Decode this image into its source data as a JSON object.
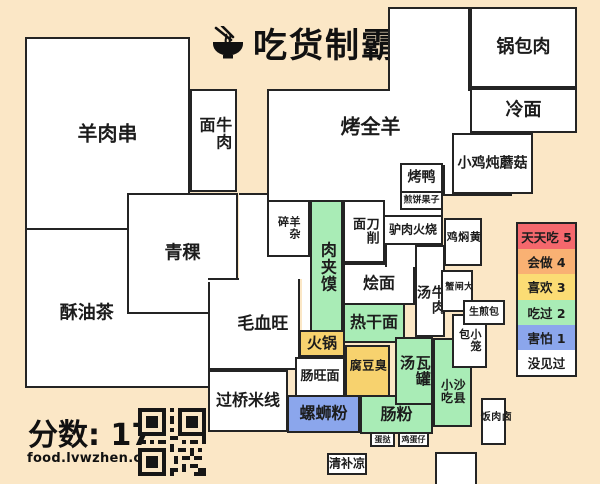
{
  "page": {
    "title": "吃货制霸",
    "score_label": "分数: 17",
    "url": "food.lvwzhen.com"
  },
  "colors": {
    "bg": "#fbe7c6",
    "border": "#242424",
    "w": "#ffffff",
    "g": "#a9ecb6",
    "y": "#f7d26e",
    "b": "#8ba6ec",
    "red": "#f5686d",
    "orange": "#f9b173",
    "lemon": "#fbdc74"
  },
  "legend": {
    "items": [
      {
        "label": "天天吃 5",
        "color": "#f5686d"
      },
      {
        "label": "会做 4",
        "color": "#f9b173"
      },
      {
        "label": "喜欢 3",
        "color": "#fbdc74"
      },
      {
        "label": "吃过 2",
        "color": "#a9ecb6"
      },
      {
        "label": "害怕 1",
        "color": "#8ba6ec"
      },
      {
        "label": "没见过",
        "color": "#ffffff"
      }
    ]
  },
  "regions": [
    {
      "n": "kaoquanyang",
      "t": "烤全羊",
      "x": 267,
      "y": 89,
      "w": 176,
      "h": 128,
      "fs": 20,
      "lx": 59,
      "ly": 29
    },
    {
      "n": "kaoquanyang-east",
      "t": "",
      "x": 443,
      "y": 89,
      "w": 69,
      "h": 107
    },
    {
      "n": "kaoquanyang-north",
      "t": "",
      "x": 388,
      "y": 7,
      "w": 82,
      "h": 84
    },
    {
      "n": "seam-north",
      "t": "",
      "x": 390,
      "y": 86,
      "w": 78,
      "h": 8,
      "br": "none"
    },
    {
      "n": "seam-east",
      "t": "",
      "x": 441,
      "y": 91,
      "w": 6,
      "h": 74,
      "br": "none"
    },
    {
      "n": "guobaorou",
      "t": "锅包肉",
      "x": 470,
      "y": 7,
      "w": 107,
      "h": 81,
      "fs": 18
    },
    {
      "n": "lengmian",
      "t": "冷面",
      "x": 470,
      "y": 88,
      "w": 107,
      "h": 45,
      "fs": 18
    },
    {
      "n": "xiaojidunmogu",
      "t": "小鸡炖蘑菇",
      "x": 452,
      "y": 133,
      "w": 81,
      "h": 61,
      "fs": 14
    },
    {
      "n": "yangrouchuan",
      "t": "羊肉串",
      "x": 25,
      "y": 37,
      "w": 165,
      "h": 193,
      "fs": 20
    },
    {
      "n": "niuroumian",
      "t": "牛肉面",
      "x": 190,
      "y": 89,
      "w": 47,
      "h": 103,
      "fs": 16,
      "v": 1
    },
    {
      "n": "suyoucha",
      "t": "酥油茶",
      "x": 25,
      "y": 228,
      "w": 185,
      "h": 160,
      "fs": 18,
      "lx": 33,
      "ly": 54
    },
    {
      "n": "qingke",
      "t": "青稞",
      "x": 127,
      "y": 193,
      "w": 111,
      "h": 121,
      "fs": 18
    },
    {
      "n": "maoxuewang",
      "t": "毛血旺",
      "x": 208,
      "y": 278,
      "w": 92,
      "h": 92,
      "fs": 17,
      "lx": 60,
      "ly": 52,
      "br": "lrb"
    },
    {
      "n": "maoxuewang-topline",
      "t": "",
      "x": 208,
      "y": 278,
      "w": 31,
      "h": 4,
      "br": "top"
    },
    {
      "n": "yangzasui",
      "t": "羊杂碎",
      "x": 267,
      "y": 200,
      "w": 43,
      "h": 57,
      "fs": 11,
      "v": 1
    },
    {
      "n": "gap-west",
      "t": "",
      "x": 239,
      "y": 193,
      "w": 28,
      "h": 89,
      "br": "top"
    },
    {
      "n": "gap-mid",
      "t": "",
      "x": 267,
      "y": 257,
      "w": 43,
      "h": 22,
      "br": "none"
    },
    {
      "n": "gap-east",
      "t": "",
      "x": 302,
      "y": 257,
      "w": 8,
      "h": 75,
      "br": "none"
    },
    {
      "n": "roujiamo",
      "t": "肉夹馍",
      "x": 310,
      "y": 200,
      "w": 33,
      "h": 133,
      "fs": 16,
      "v": 1,
      "c": "g"
    },
    {
      "n": "daoxiaomian",
      "t": "刀削面",
      "x": 343,
      "y": 200,
      "w": 42,
      "h": 63,
      "fs": 13,
      "v": 1
    },
    {
      "n": "kaoya",
      "t": "烤鸭",
      "x": 400,
      "y": 163,
      "w": 43,
      "h": 30,
      "fs": 14
    },
    {
      "n": "jianbingguozi",
      "t": "煎饼果子",
      "x": 400,
      "y": 191,
      "w": 43,
      "h": 19,
      "fs": 9
    },
    {
      "n": "lvrouhuoshao",
      "t": "驴肉火烧",
      "x": 383,
      "y": 215,
      "w": 60,
      "h": 30,
      "fs": 12
    },
    {
      "n": "huimian",
      "t": "烩面",
      "x": 343,
      "y": 263,
      "w": 72,
      "h": 42,
      "fs": 16
    },
    {
      "n": "huimian-notch",
      "t": "",
      "x": 385,
      "y": 245,
      "w": 30,
      "h": 22,
      "br": "left"
    },
    {
      "n": "niuroutang",
      "t": "牛肉汤",
      "x": 415,
      "y": 245,
      "w": 30,
      "h": 92,
      "fs": 14,
      "v": 1,
      "ly": 62
    },
    {
      "n": "huangmenji",
      "t": "黄焖鸡",
      "x": 444,
      "y": 218,
      "w": 38,
      "h": 48,
      "fs": 11,
      "v": 1
    },
    {
      "n": "dazhaxie",
      "t": "大闸蟹",
      "x": 441,
      "y": 270,
      "w": 32,
      "h": 42,
      "fs": 9,
      "v": 1
    },
    {
      "n": "reganmian",
      "t": "热干面",
      "x": 343,
      "y": 303,
      "w": 62,
      "h": 40,
      "fs": 16,
      "c": "g"
    },
    {
      "n": "huoguo",
      "t": "火锅",
      "x": 299,
      "y": 330,
      "w": 46,
      "h": 27,
      "fs": 15,
      "c": "y"
    },
    {
      "n": "changwangmian",
      "t": "肠旺面",
      "x": 295,
      "y": 357,
      "w": 50,
      "h": 40,
      "fs": 13
    },
    {
      "n": "choudoufu",
      "t": "臭豆腐",
      "x": 345,
      "y": 345,
      "w": 45,
      "h": 52,
      "fs": 12,
      "v": 1,
      "c": "y"
    },
    {
      "n": "guoqiaomixian",
      "t": "过桥米线",
      "x": 208,
      "y": 370,
      "w": 80,
      "h": 62,
      "fs": 16
    },
    {
      "n": "luosifen",
      "t": "螺蛳粉",
      "x": 287,
      "y": 395,
      "w": 73,
      "h": 38,
      "fs": 16,
      "c": "b"
    },
    {
      "n": "changfen",
      "t": "肠粉",
      "x": 360,
      "y": 395,
      "w": 73,
      "h": 39,
      "fs": 16,
      "c": "g"
    },
    {
      "n": "waguantang",
      "t": "瓦罐汤",
      "x": 395,
      "y": 337,
      "w": 38,
      "h": 68,
      "fs": 15,
      "v": 1,
      "c": "g"
    },
    {
      "n": "shaxianxiaochi",
      "t": "沙县小吃",
      "x": 433,
      "y": 338,
      "w": 39,
      "h": 89,
      "fs": 12,
      "v": 1,
      "c": "g",
      "ly": 63
    },
    {
      "n": "xiaolongbao",
      "t": "小笼包",
      "x": 452,
      "y": 314,
      "w": 35,
      "h": 54,
      "fs": 11,
      "v": 1
    },
    {
      "n": "shengjianbao",
      "t": "生煎包",
      "x": 463,
      "y": 300,
      "w": 42,
      "h": 25,
      "fs": 10
    },
    {
      "n": "luroufan",
      "t": "卤肉饭",
      "x": 481,
      "y": 398,
      "w": 25,
      "h": 47,
      "fs": 10,
      "v": 1
    },
    {
      "n": "danta",
      "t": "蛋挞",
      "x": 370,
      "y": 432,
      "w": 25,
      "h": 15,
      "fs": 8
    },
    {
      "n": "jidanzai",
      "t": "鸡蛋仔",
      "x": 398,
      "y": 432,
      "w": 31,
      "h": 15,
      "fs": 8
    },
    {
      "n": "qingbuliang",
      "t": "清补凉",
      "x": 327,
      "y": 453,
      "w": 40,
      "h": 22,
      "fs": 12
    },
    {
      "n": "unknown-region",
      "t": "",
      "x": 435,
      "y": 452,
      "w": 42,
      "h": 34
    }
  ]
}
